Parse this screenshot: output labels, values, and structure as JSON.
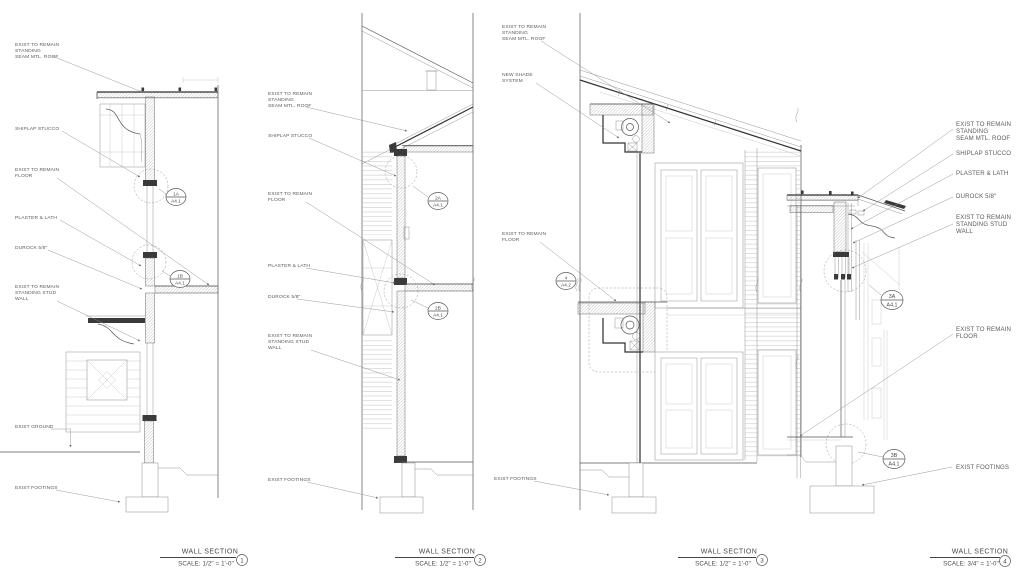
{
  "sheet": {
    "background": "#ffffff",
    "line_ink": "#4a4a4a",
    "text_ink": "#5b5b5b"
  },
  "sections": [
    {
      "number": "1",
      "title": "WALL SECTION",
      "scale": "SCALE: 1/2\" = 1'-0\"",
      "labels": {
        "roof1": "EXIST TO REMAIN",
        "roof2": "STANDING",
        "roof3": "SEAM MTL. ROOF",
        "stucco": "SHIPLAP STUCCO",
        "floor1": "EXIST TO REMAIN",
        "floor2": "FLOOR",
        "plaster": "PLASTER & LATH",
        "durock": "DUROCK 5/8\"",
        "stud1": "EXIST TO REMAIN",
        "stud2": "STANDING STUD",
        "stud3": "WALL",
        "ground": "EXIST GROUND",
        "footings": "EXIST FOOTINGS"
      },
      "callouts": [
        {
          "ref": "1A",
          "sheet": "A4.1"
        },
        {
          "ref": "1B",
          "sheet": "A4.1"
        }
      ]
    },
    {
      "number": "2",
      "title": "WALL SECTION",
      "scale": "SCALE: 1/2\" = 1'-0\"",
      "labels": {
        "roof1": "EXIST TO REMAIN",
        "roof2": "STANDING",
        "roof3": "SEAM MTL. ROOF",
        "stucco": "SHIPLAP STUCCO",
        "floor1": "EXIST TO REMAIN",
        "floor2": "FLOOR",
        "plaster": "PLASTER & LATH",
        "durock": "DUROCK 5/8\"",
        "stud1": "EXIST TO REMAIN",
        "stud2": "STANDING STUD",
        "stud3": "WALL",
        "footings": "EXIST FOOTINGS"
      },
      "callouts": [
        {
          "ref": "2A",
          "sheet": "A4.1"
        },
        {
          "ref": "2B",
          "sheet": "A4.1"
        }
      ]
    },
    {
      "number": "3",
      "title": "WALL SECTION",
      "scale": "SCALE: 1/2\" = 1'-0\"",
      "labels": {
        "roof1": "EXIST TO REMAIN",
        "roof2": "STANDING",
        "roof3": "SEAM MTL. ROOF",
        "shade1": "NEW SHADE",
        "shade2": "SYSTEM",
        "floor1": "EXIST TO REMAIN",
        "floor2": "FLOOR",
        "footings": "EXIST FOOTINGS"
      },
      "callouts": [
        {
          "ref": "4",
          "sheet": "A4.2"
        }
      ]
    },
    {
      "number": "4",
      "title": "WALL SECTION",
      "scale": "SCALE: 3/4\" = 1'-0\"",
      "labels": {
        "roof1": "EXIST TO REMAIN",
        "roof2": "STANDING",
        "roof3": "SEAM MTL. ROOF",
        "stucco": "SHIPLAP STUCCO",
        "plaster": "PLASTER & LATH",
        "durock": "DUROCK 5/8\"",
        "stud1": "EXIST TO REMAIN",
        "stud2": "STANDING STUD",
        "stud3": "WALL",
        "floor1": "EXIST TO REMAIN",
        "floor2": "FLOOR",
        "footings": "EXIST FOOTINGS"
      },
      "callouts": [
        {
          "ref": "3A",
          "sheet": "A4.1"
        },
        {
          "ref": "3B",
          "sheet": "A4.1"
        }
      ]
    }
  ]
}
